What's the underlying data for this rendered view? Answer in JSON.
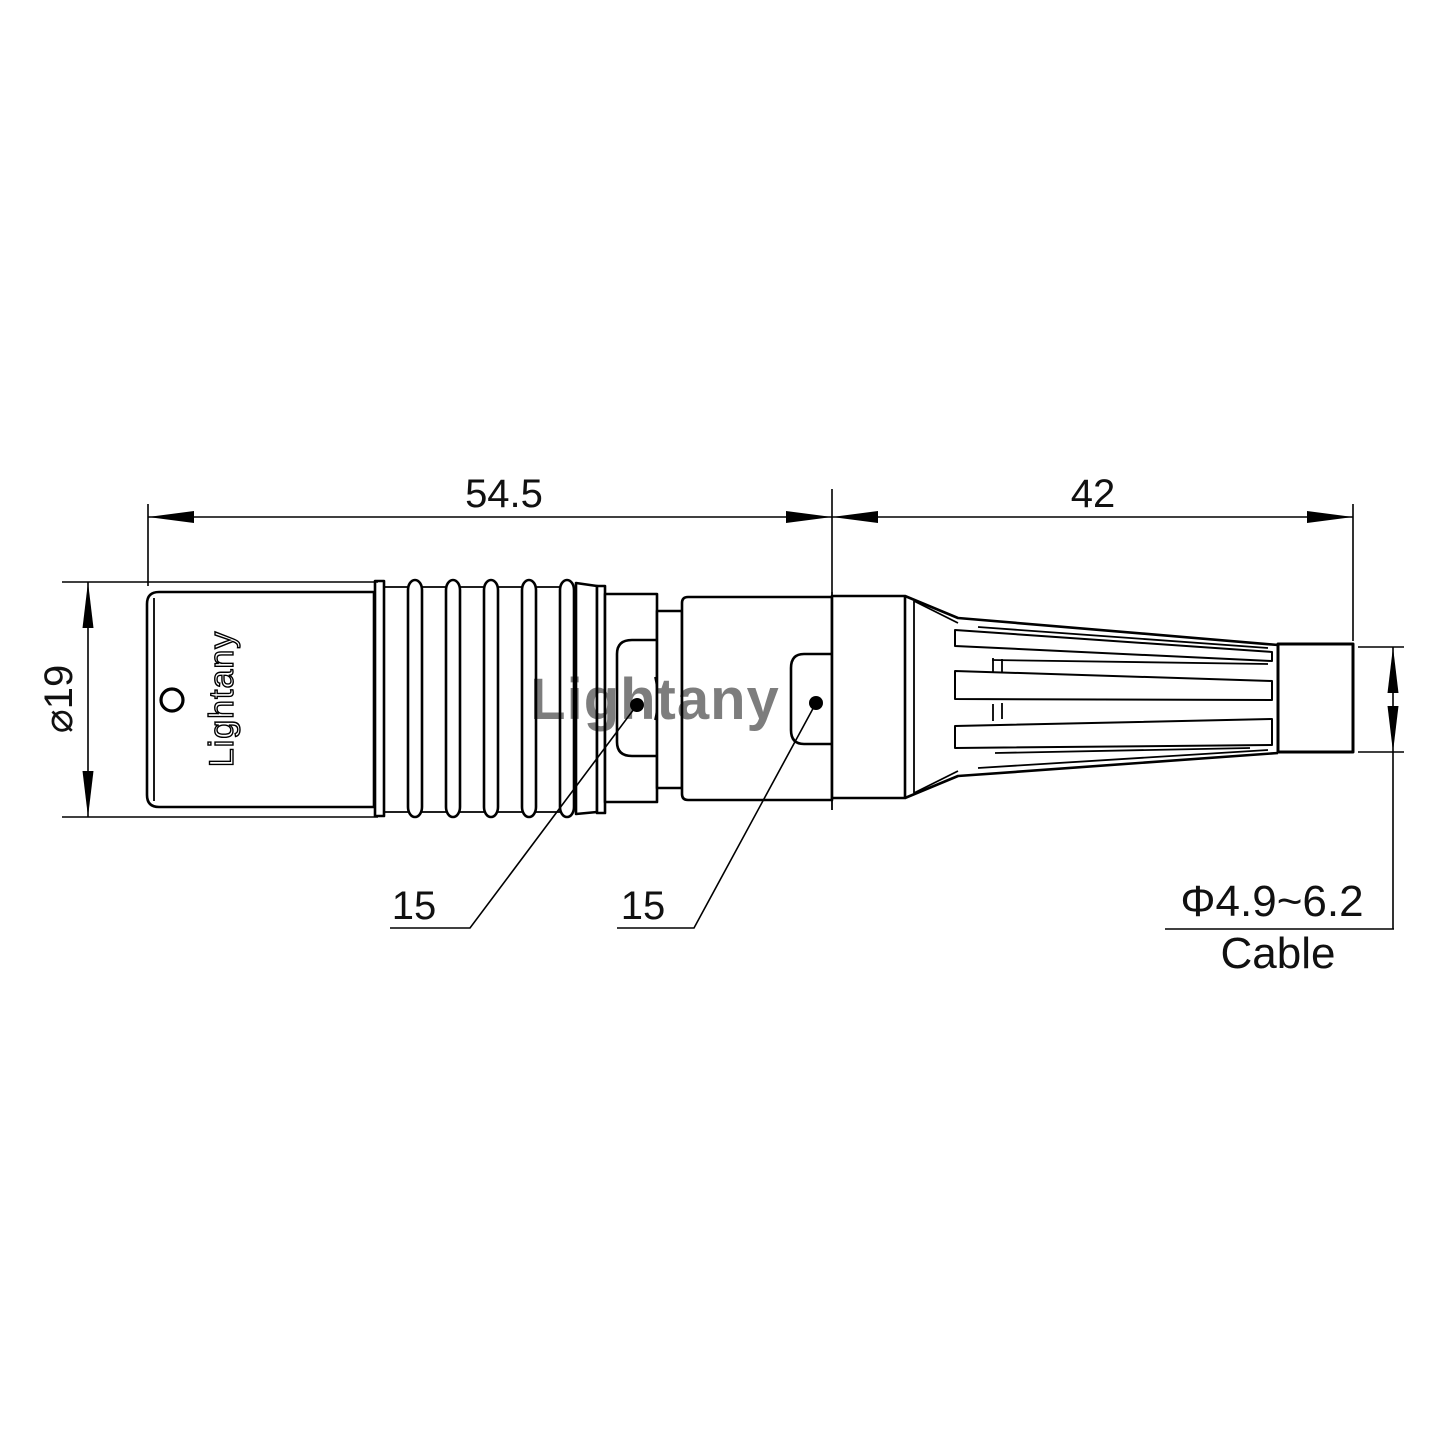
{
  "drawing": {
    "watermark": "Lightany",
    "body_engraving": "Lightany",
    "dimensions": {
      "front_length": "54.5",
      "rear_length": "42",
      "flange_diameter": "⌀19",
      "front_latch": "15",
      "rear_latch": "15",
      "cable_range": "Φ4.9~6.2",
      "cable_label": "Cable"
    },
    "colors": {
      "line": "#000000",
      "text": "#111111",
      "watermark": "#ef9a9a",
      "background": "#ffffff"
    }
  }
}
